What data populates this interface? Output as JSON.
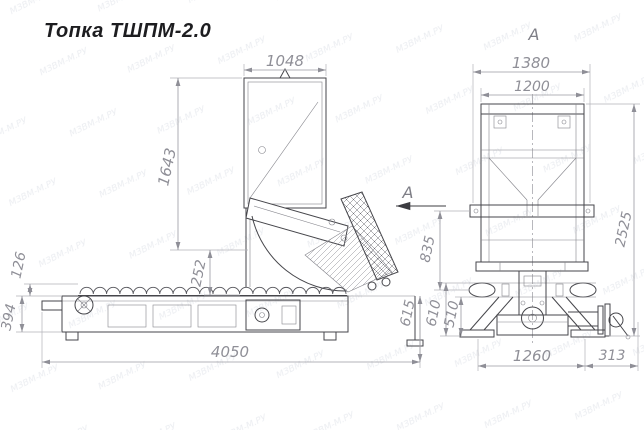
{
  "title": "Топка ТШПМ-2.0",
  "watermark": {
    "text": "МЗВМ-М.РУ"
  },
  "side_view": {
    "section_arrow": "А",
    "dims": {
      "top_width": "1048",
      "hopper_height": "1643",
      "throat_height": "252",
      "auger_height": "126",
      "frame_height": "394",
      "total_length": "4050",
      "outlet_height": "615"
    }
  },
  "front_view": {
    "label": "А",
    "dims": {
      "outer_width": "1380",
      "body_width": "1200",
      "total_height": "2525",
      "mid_height": "835",
      "lower_height": "610",
      "base_height": "510",
      "base_width": "1260",
      "shaft_length": "313"
    }
  }
}
